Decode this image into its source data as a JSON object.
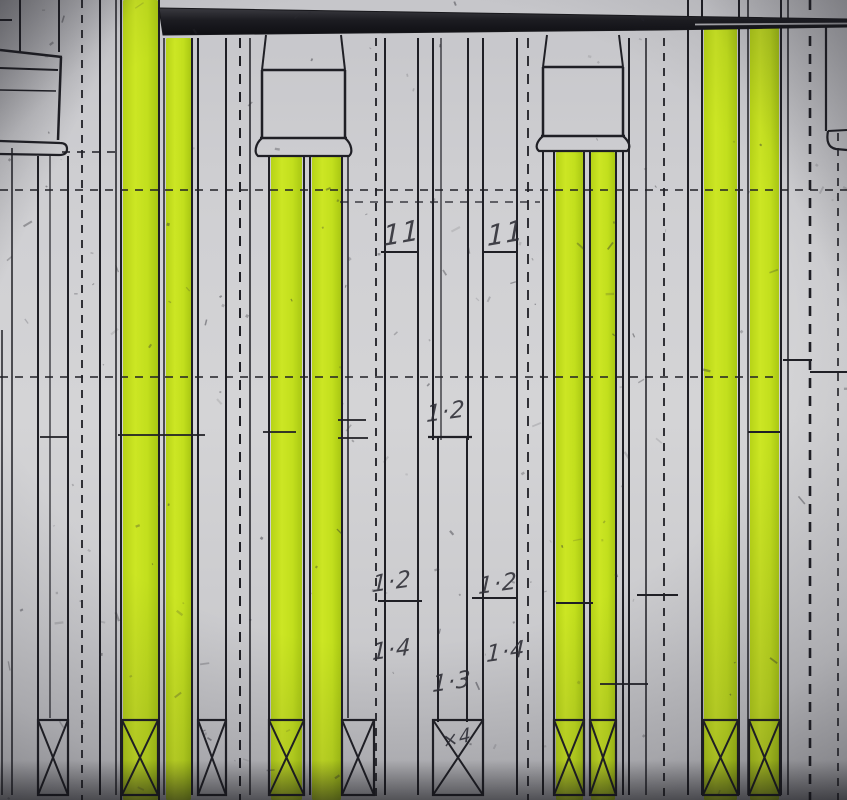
{
  "colors": {
    "paper": "#cfcfd3",
    "ink": "#1e1e24",
    "ink_soft": "#2b2b32",
    "highlight": "#c6e31e",
    "highlight_bright": "#d3ee2e",
    "highlight_deep": "#a9c713",
    "band": "#17171b",
    "annotation_ink": "#2c2c34"
  },
  "annotations": [
    {
      "text": "11",
      "x": 383,
      "y": 246,
      "size": 28,
      "rot": -10
    },
    {
      "text": "11",
      "x": 487,
      "y": 246,
      "size": 28,
      "rot": -10
    },
    {
      "text": "1·2",
      "x": 426,
      "y": 422,
      "size": 23,
      "rot": -8
    },
    {
      "text": "1·2",
      "x": 372,
      "y": 592,
      "size": 23,
      "rot": -8
    },
    {
      "text": "1·2",
      "x": 478,
      "y": 594,
      "size": 23,
      "rot": -8
    },
    {
      "text": "1·4",
      "x": 372,
      "y": 660,
      "size": 23,
      "rot": -8
    },
    {
      "text": "1·4",
      "x": 486,
      "y": 662,
      "size": 23,
      "rot": -8
    },
    {
      "text": "1·3",
      "x": 432,
      "y": 692,
      "size": 23,
      "rot": -8
    },
    {
      "text": "×4",
      "x": 443,
      "y": 748,
      "size": 19,
      "rot": -14
    }
  ],
  "drawing": {
    "width": 847,
    "height": 800,
    "band": {
      "path": "M 159 8 L 847 19 L 847 27 L 660 30 L 163 35 Z",
      "split": "M 695 24.5 L 847 23.5"
    },
    "highlights": [
      [
        123,
        0,
        35,
        800
      ],
      [
        166,
        38,
        25,
        762
      ],
      [
        271,
        157,
        31,
        643
      ],
      [
        312,
        157,
        29,
        643
      ],
      [
        556,
        152,
        27,
        648
      ],
      [
        591,
        152,
        24,
        648
      ],
      [
        704,
        25,
        33,
        775
      ],
      [
        750,
        25,
        29,
        775
      ]
    ],
    "v_lines": [
      [
        2,
        330,
        795,
        1.5,
        "s"
      ],
      [
        12,
        148,
        795,
        1.5,
        "s"
      ],
      [
        20,
        0,
        52,
        2,
        "s"
      ],
      [
        59,
        0,
        52,
        2,
        "s"
      ],
      [
        38,
        156,
        795,
        2,
        "s"
      ],
      [
        50,
        156,
        718,
        1.2,
        "s"
      ],
      [
        68,
        156,
        795,
        2,
        "s"
      ],
      [
        82,
        0,
        800,
        1.8,
        "d"
      ],
      [
        100,
        0,
        795,
        2,
        "s"
      ],
      [
        116,
        0,
        795,
        1.5,
        "s"
      ],
      [
        121,
        0,
        800,
        2,
        "s"
      ],
      [
        159,
        0,
        800,
        2,
        "s"
      ],
      [
        164,
        38,
        795,
        1.5,
        "s"
      ],
      [
        192,
        38,
        795,
        2,
        "s"
      ],
      [
        198,
        38,
        795,
        2,
        "s"
      ],
      [
        226,
        38,
        795,
        2,
        "s"
      ],
      [
        240,
        38,
        800,
        2,
        "D"
      ],
      [
        250,
        38,
        795,
        1.5,
        "s"
      ],
      [
        269,
        157,
        795,
        2,
        "s"
      ],
      [
        304,
        157,
        795,
        2,
        "s"
      ],
      [
        310,
        157,
        795,
        2,
        "s"
      ],
      [
        342,
        157,
        795,
        2,
        "s"
      ],
      [
        348,
        157,
        718,
        1.5,
        "s"
      ],
      [
        376,
        38,
        800,
        1.8,
        "d"
      ],
      [
        385,
        38,
        795,
        2,
        "s"
      ],
      [
        418,
        38,
        795,
        2,
        "s"
      ],
      [
        433,
        38,
        440,
        2,
        "s"
      ],
      [
        441,
        38,
        440,
        1.2,
        "s"
      ],
      [
        468,
        38,
        440,
        2,
        "s"
      ],
      [
        438,
        437,
        722,
        2,
        "s"
      ],
      [
        467,
        437,
        722,
        2,
        "s"
      ],
      [
        483,
        38,
        795,
        2,
        "s"
      ],
      [
        517,
        38,
        795,
        2,
        "s"
      ],
      [
        528,
        38,
        800,
        1.8,
        "D"
      ],
      [
        543,
        152,
        795,
        2,
        "s"
      ],
      [
        554,
        152,
        795,
        2,
        "s"
      ],
      [
        584,
        152,
        795,
        2,
        "s"
      ],
      [
        590,
        152,
        795,
        2,
        "s"
      ],
      [
        616,
        152,
        795,
        2,
        "s"
      ],
      [
        623,
        152,
        795,
        2,
        "s"
      ],
      [
        629,
        38,
        795,
        2,
        "s"
      ],
      [
        646,
        38,
        795,
        1.5,
        "s"
      ],
      [
        664,
        38,
        800,
        1.8,
        "d"
      ],
      [
        688,
        0,
        795,
        2,
        "s"
      ],
      [
        702,
        0,
        795,
        2,
        "s"
      ],
      [
        739,
        0,
        795,
        2,
        "s"
      ],
      [
        748,
        0,
        795,
        1.5,
        "s"
      ],
      [
        781,
        0,
        795,
        2,
        "s"
      ],
      [
        788,
        0,
        795,
        1.5,
        "s"
      ],
      [
        810,
        0,
        800,
        2.6,
        "D"
      ],
      [
        826,
        20,
        131,
        2.2,
        "s"
      ],
      [
        838,
        133,
        800,
        1.6,
        "d"
      ]
    ],
    "h_segments": [
      [
        0,
        12,
        20,
        2,
        "s"
      ],
      [
        62,
        120,
        152,
        1.5,
        "d"
      ],
      [
        0,
        847,
        190,
        1.5,
        "d"
      ],
      [
        340,
        540,
        202,
        1.3,
        "d"
      ],
      [
        381,
        417,
        252,
        2,
        "s"
      ],
      [
        483,
        517,
        252,
        2,
        "s"
      ],
      [
        0,
        780,
        377,
        1.5,
        "d"
      ],
      [
        338,
        366,
        420,
        1.8,
        "s"
      ],
      [
        40,
        68,
        437,
        1.8,
        "s"
      ],
      [
        118,
        205,
        435,
        1.8,
        "s"
      ],
      [
        263,
        296,
        432,
        1.8,
        "s"
      ],
      [
        338,
        368,
        438,
        1.8,
        "s"
      ],
      [
        428,
        472,
        437,
        2.2,
        "s"
      ],
      [
        748,
        781,
        432,
        2,
        "s"
      ],
      [
        783,
        812,
        360,
        2,
        "s"
      ],
      [
        810,
        847,
        372,
        2,
        "s"
      ],
      [
        378,
        422,
        601,
        2,
        "s"
      ],
      [
        472,
        517,
        598,
        2,
        "s"
      ],
      [
        556,
        593,
        603,
        2,
        "s"
      ],
      [
        637,
        678,
        595,
        2,
        "s"
      ],
      [
        600,
        648,
        684,
        1.8,
        "s"
      ]
    ],
    "capitals": [
      {
        "left": 262,
        "right": 345,
        "neck_top": 35,
        "block_top": 70,
        "block_bottom": 138,
        "flare_bottom": 157,
        "out": 7
      },
      {
        "left": 543,
        "right": 623,
        "neck_top": 35,
        "block_top": 67,
        "block_bottom": 136,
        "flare_bottom": 152,
        "out": 7
      }
    ],
    "paths": [
      {
        "d": "M 0 50 L 62 57",
        "w": 2.5
      },
      {
        "d": "M 0 68 L 58 70",
        "w": 2
      },
      {
        "d": "M 0 90 L 56 91",
        "w": 1.5
      },
      {
        "d": "M 61 57 L 58 140",
        "w": 2.5
      },
      {
        "d": "M 0 141 L 60 143 Q 67 143 67 149 Q 67 155 59 155 L 0 154",
        "w": 2.2
      },
      {
        "d": "M 847 130 L 828 131",
        "w": 2
      },
      {
        "d": "M 828 131 Q 825 147 836 149 L 847 150",
        "w": 2.2
      }
    ],
    "xboxes": [
      [
        38,
        68
      ],
      [
        122,
        158
      ],
      [
        198,
        226
      ],
      [
        269,
        304
      ],
      [
        342,
        374
      ],
      [
        433,
        483
      ],
      [
        554,
        584
      ],
      [
        590,
        616
      ],
      [
        703,
        738
      ],
      [
        749,
        780
      ]
    ],
    "xbox_top": 720,
    "xbox_bottom": 795
  }
}
